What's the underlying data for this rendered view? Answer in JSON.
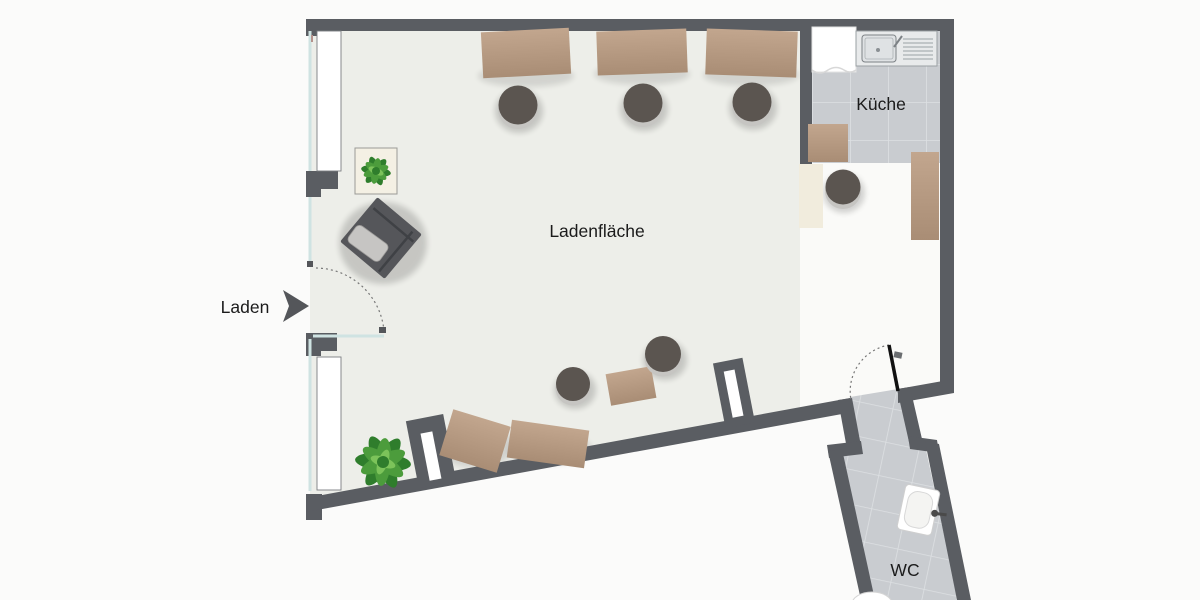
{
  "title": "Ladenfläche Grundriss",
  "rooms": {
    "main": {
      "label": "Ladenfläche"
    },
    "kitchen": {
      "label": "Küche"
    },
    "wc": {
      "label": "WC"
    }
  },
  "entrance": {
    "label": "Laden",
    "arrow_icon": "arrow-right-icon"
  },
  "colors": {
    "background": "#fbfbfa",
    "wall": "#5a5d62",
    "floor_main": "#edeee9",
    "floor_light": "#fafaf8",
    "tile": "#c9ccd0",
    "tile_grout": "#dde0e3",
    "wood_light": "#c2a68e",
    "wood_dark": "#a98d75",
    "stool": "#5b5550",
    "stool_ring": "#c6c5c2",
    "glass": "#cfe3e2",
    "fixture_white": "#ffffff",
    "cream": "#f1ecdd",
    "plant_green": "#4c9c3c",
    "plant_green_dark": "#2f7d2c",
    "chair": "#55565a",
    "cushion": "#c6c5c3",
    "text": "#1b1b1b",
    "door_dash": "#777777",
    "door_leaf": "#111111"
  }
}
